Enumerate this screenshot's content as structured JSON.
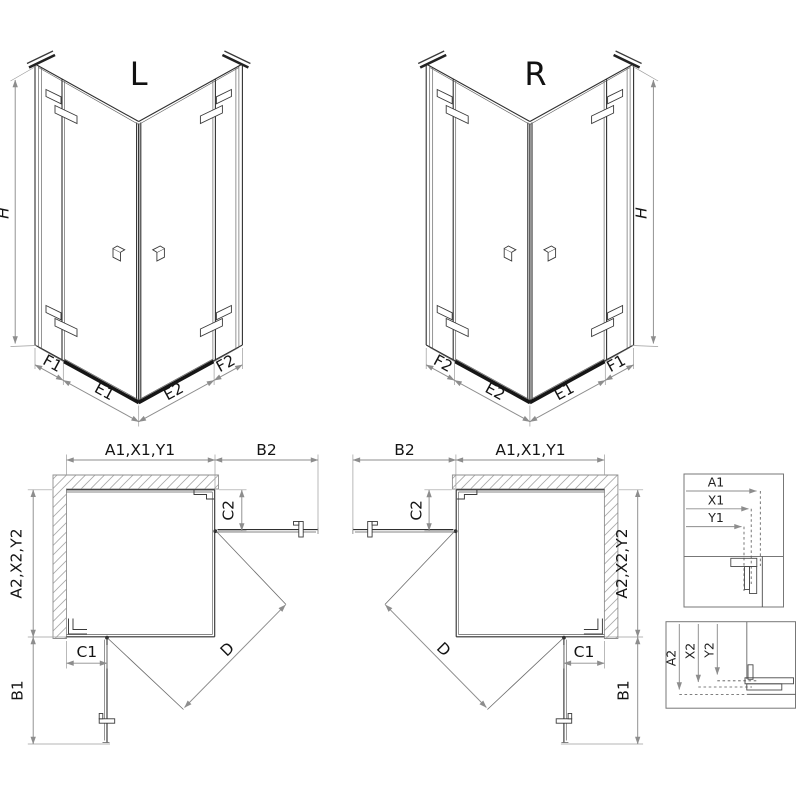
{
  "colors": {
    "line": "#2f2f2f",
    "dimension_line": "#8d8d8d",
    "hatch": "#a9a9a9",
    "text": "#141414",
    "threshold_profile": "#161616",
    "background": "#ffffff"
  },
  "iso_left": {
    "title": "L",
    "height_label": "H",
    "bottom_labels": {
      "f1": "F1",
      "e1": "E1",
      "e2": "E2",
      "f2": "F2"
    }
  },
  "iso_right": {
    "title": "R",
    "height_label": "H",
    "bottom_labels": {
      "f2": "F2",
      "e2": "E2",
      "e1": "E1",
      "f1": "F1"
    }
  },
  "plan_left": {
    "width_label": "A1,X1,Y1",
    "door_open_side_label": "B2",
    "fixed_panel_side_label": "C2",
    "depth_label": "A2,X2,Y2",
    "fixed_panel_bottom_label": "C1",
    "door_open_bottom_label": "B1",
    "diagonal_label": "D"
  },
  "plan_right": {
    "width_label": "A1,X1,Y1",
    "door_open_side_label": "B2",
    "fixed_panel_side_label": "C2",
    "depth_label": "A2,X2,Y2",
    "fixed_panel_bottom_label": "C1",
    "door_open_bottom_label": "B1",
    "diagonal_label": "D"
  },
  "detail_top": {
    "row1": "A1",
    "row2": "X1",
    "row3": "Y1"
  },
  "detail_bottom": {
    "col1": "A2",
    "col2": "X2",
    "col3": "Y2"
  }
}
